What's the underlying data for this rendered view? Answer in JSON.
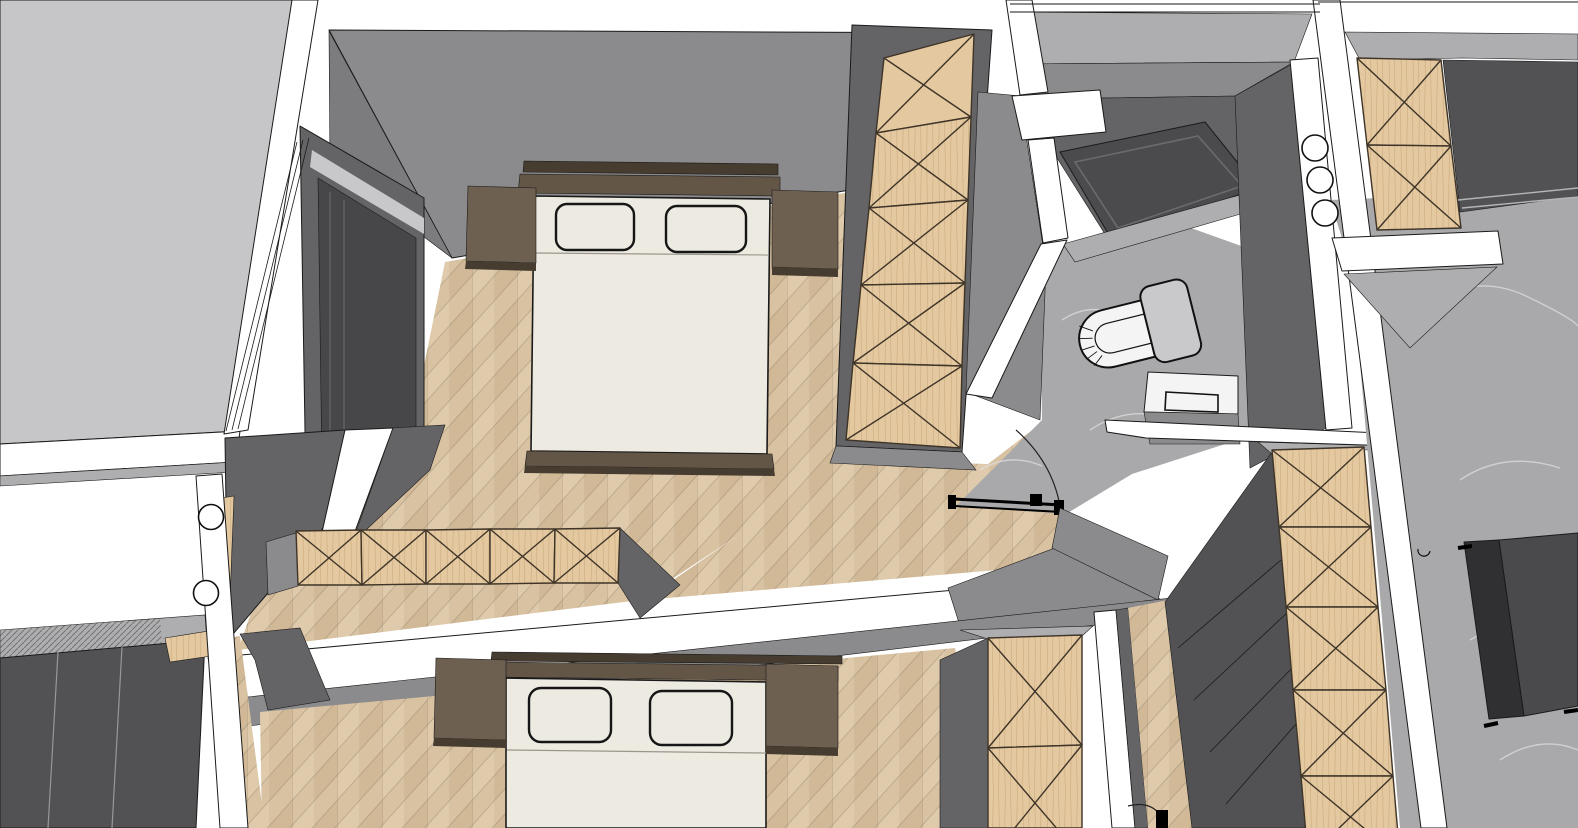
{
  "view": {
    "title": "apartment-3d-floorplan-overhead-view",
    "style": "sketchup-like perspective bird's-eye section render",
    "visible_text": "none"
  },
  "palette": {
    "outline": "#1a1a1a",
    "white_wall": "#ffffff",
    "exterior_slab": "#c6c6c8",
    "wall_light": "#aeaeb0",
    "wall_mid": "#8b8b8d",
    "wall_dark": "#646466",
    "wall_darker": "#525254",
    "glass_dark": "#47474a",
    "wood_floor_base": "#d8c2a2",
    "wood_floor_light": "#e1cdae",
    "wood_floor_dark": "#cbb28e",
    "cabinet_wood": "#e4c89f",
    "cabinet_wood_grain": "#c8a87c",
    "cabinet_line": "#3e3428",
    "bed_frame": "#635646",
    "bed_frame_dark": "#463c30",
    "nightstand_top": "#6e6051",
    "mattress": "#edeae1",
    "marble_base": "#a9a9ab",
    "marble_vein": "#dedee0",
    "marble_dark": "#4b4b4d",
    "toilet_white": "#f4f4f4",
    "toilet_lid": "#c9c9cb",
    "sofa_dark": "#4a4a4c",
    "sofa_darker": "#303032"
  },
  "scene": {
    "rooms": [
      {
        "name": "master-bedroom",
        "floor": "herringbone wood",
        "furniture": [
          "double-bed",
          "two-pillows",
          "nightstand-left",
          "nightstand-right",
          "tall-wardrobe-x-front",
          "low-sideboard-x-front",
          "window-west-wall"
        ]
      },
      {
        "name": "second-bedroom",
        "floor": "herringbone wood",
        "furniture": [
          "double-bed",
          "two-pillows",
          "nightstand-left",
          "nightstand-right",
          "sliding-door-wardrobe-dark",
          "tall-wardrobe-x-front"
        ]
      },
      {
        "name": "bathroom",
        "floor": "grey marble",
        "furniture": [
          "walk-in-shower-dark",
          "toilet-open-lid",
          "washbasin-cabinet",
          "swing-door-open"
        ]
      },
      {
        "name": "hallway-living-area",
        "floor": "grey marble",
        "furniture": [
          "tall-cabinet-x-front",
          "dark-lounge-seat",
          "wall-columns-round"
        ]
      }
    ],
    "doors": [
      {
        "name": "bathroom-door",
        "state": "open",
        "swing_arc": true
      },
      {
        "name": "second-bedroom-door",
        "state": "open",
        "swing_arc": true
      }
    ]
  }
}
